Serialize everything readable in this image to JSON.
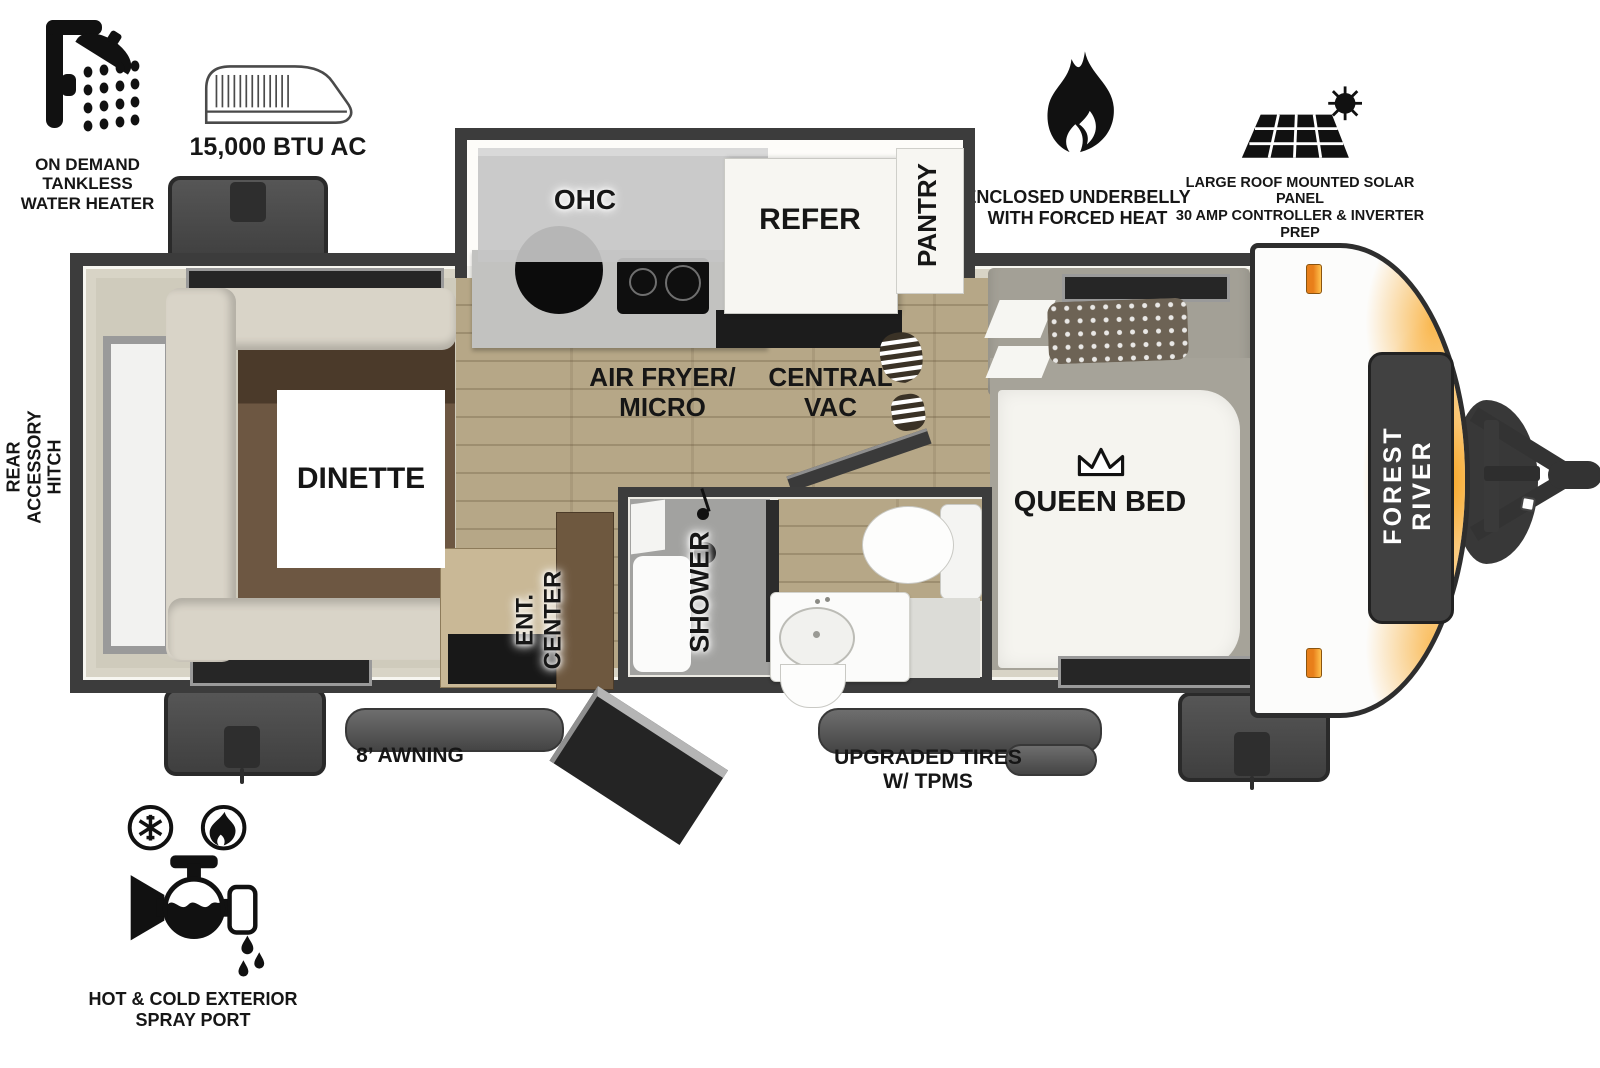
{
  "callouts": {
    "water_heater": "ON DEMAND\nTANKLESS\nWATER HEATER",
    "ac": "15,000 BTU AC",
    "underbelly": "ENCLOSED UNDERBELLY\nWITH FORCED HEAT",
    "solar": "LARGE ROOF MOUNTED SOLAR PANEL\n30 AMP CONTROLLER & INVERTER PREP",
    "rear_hitch": "REAR\nACCESSORY\nHITCH",
    "awning": "8’ AWNING",
    "tires": "UPGRADED TIRES\nW/ TPMS",
    "spray_port": "HOT & COLD EXTERIOR\nSPRAY PORT"
  },
  "rooms": {
    "dinette": "DINETTE",
    "ohc": "OHC",
    "refer": "REFER",
    "pantry": "PANTRY",
    "air_fryer": "AIR FRYER/\nMICRO",
    "central_vac": "CENTRAL\nVAC",
    "queen_bed": "QUEEN BED",
    "ent_center": "ENT.\nCENTER",
    "shower": "SHOWER"
  },
  "brand": "FOREST RIVER",
  "colors": {
    "wall_dark": "#3c3c3c",
    "wall_inner": "#d8d4c6",
    "floor_wood": "#b6a787",
    "accent_orange": "#f7941d",
    "cap_panel": "#414141"
  }
}
